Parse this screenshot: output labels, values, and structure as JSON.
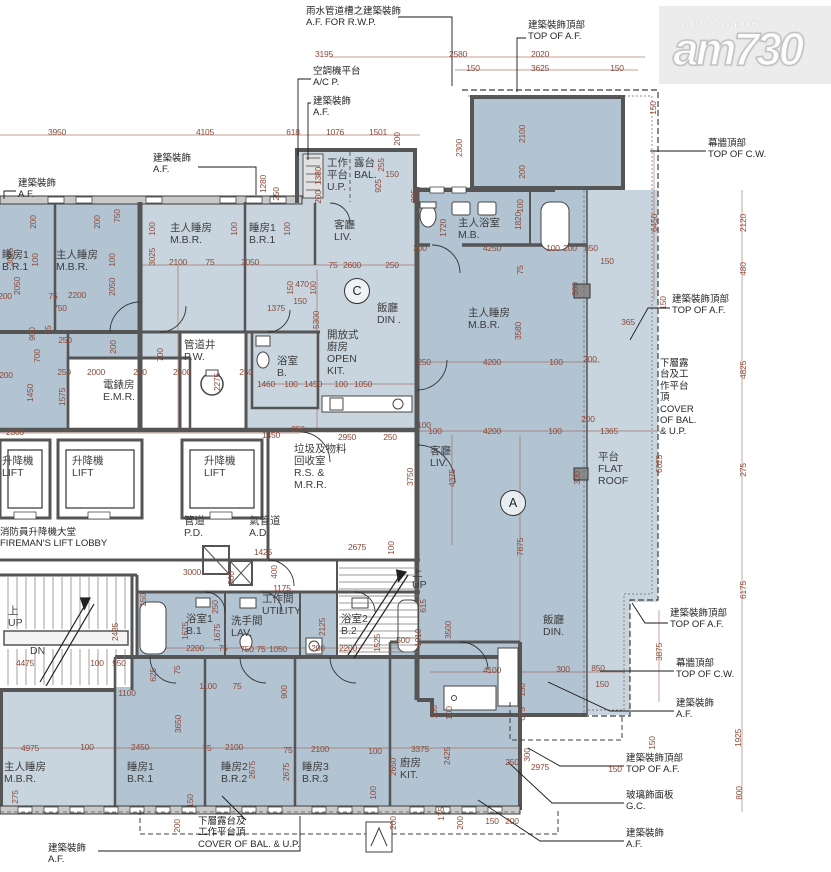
{
  "watermark": {
    "brand": "am730",
    "tagline": "my place my paper"
  },
  "unit_markers": [
    {
      "label": "C",
      "x": 357,
      "y": 291
    },
    {
      "label": "A",
      "x": 513,
      "y": 503
    }
  ],
  "room_labels": [
    {
      "lines": [
        "睡房1",
        "B.R.1"
      ],
      "x": 2,
      "y": 250
    },
    {
      "lines": [
        "主人睡房",
        "M.B.R."
      ],
      "x": 56,
      "y": 250
    },
    {
      "lines": [
        "主人睡房",
        "M.B.R."
      ],
      "x": 170,
      "y": 223
    },
    {
      "lines": [
        "睡房1",
        "B.R.1"
      ],
      "x": 249,
      "y": 223
    },
    {
      "lines": [
        "客廳",
        "LIV."
      ],
      "x": 334,
      "y": 220
    },
    {
      "lines": [
        "工作",
        "平台",
        "U.P."
      ],
      "x": 327,
      "y": 158
    },
    {
      "lines": [
        "露台",
        "BAL."
      ],
      "x": 354,
      "y": 158
    },
    {
      "lines": [
        "飯廳",
        "DIN ."
      ],
      "x": 377,
      "y": 303
    },
    {
      "lines": [
        "開放式",
        "廚房",
        "OPEN",
        "KIT."
      ],
      "x": 327,
      "y": 330
    },
    {
      "lines": [
        "浴室",
        "B."
      ],
      "x": 277,
      "y": 356
    },
    {
      "lines": [
        "管道井",
        "P.W."
      ],
      "x": 184,
      "y": 340
    },
    {
      "lines": [
        "電錶房",
        "E.M.R."
      ],
      "x": 103,
      "y": 380
    },
    {
      "lines": [
        "主人浴室",
        "M.B."
      ],
      "x": 458,
      "y": 218
    },
    {
      "lines": [
        "主人睡房",
        "M.B.R."
      ],
      "x": 468,
      "y": 308
    },
    {
      "lines": [
        "客廳",
        "LIV."
      ],
      "x": 430,
      "y": 446
    },
    {
      "lines": [
        "平台",
        "FLAT",
        "ROOF"
      ],
      "x": 598,
      "y": 452
    },
    {
      "lines": [
        "飯廳",
        "DIN."
      ],
      "x": 543,
      "y": 615
    },
    {
      "lines": [
        "升降機",
        "LIFT"
      ],
      "x": 2,
      "y": 456
    },
    {
      "lines": [
        "升降機",
        "LIFT"
      ],
      "x": 72,
      "y": 456
    },
    {
      "lines": [
        "升降機",
        "LIFT"
      ],
      "x": 204,
      "y": 456
    },
    {
      "lines": [
        "垃圾及物料",
        "回收室",
        "R.S. &",
        "M.R.R."
      ],
      "x": 294,
      "y": 444
    },
    {
      "lines": [
        "管道",
        "P.D."
      ],
      "x": 184,
      "y": 516
    },
    {
      "lines": [
        "氣管道",
        "A.D."
      ],
      "x": 249,
      "y": 516
    },
    {
      "lines": [
        "上",
        "UP"
      ],
      "x": 8,
      "y": 606
    },
    {
      "lines": [
        "DN"
      ],
      "x": 30,
      "y": 646
    },
    {
      "lines": [
        "上",
        "UP"
      ],
      "x": 412,
      "y": 568
    },
    {
      "lines": [
        "工作間",
        "UTILITY"
      ],
      "x": 262,
      "y": 594
    },
    {
      "lines": [
        "浴室1",
        "B.1"
      ],
      "x": 186,
      "y": 614
    },
    {
      "lines": [
        "洗手間",
        "LAV."
      ],
      "x": 231,
      "y": 616
    },
    {
      "lines": [
        "浴室2",
        "B.2"
      ],
      "x": 341,
      "y": 614
    },
    {
      "lines": [
        "主人睡房",
        "M.B.R."
      ],
      "x": 4,
      "y": 762
    },
    {
      "lines": [
        "睡房1",
        "B.R.1"
      ],
      "x": 127,
      "y": 762
    },
    {
      "lines": [
        "睡房2",
        "B.R.2"
      ],
      "x": 221,
      "y": 762
    },
    {
      "lines": [
        "睡房3",
        "B.R.3"
      ],
      "x": 302,
      "y": 762
    },
    {
      "lines": [
        "廚房",
        "KIT."
      ],
      "x": 400,
      "y": 758
    }
  ],
  "callouts": [
    {
      "lines": [
        "雨水管道槽之建築裝飾",
        "A.F. FOR R.W.P."
      ],
      "x": 306,
      "y": 6
    },
    {
      "lines": [
        "空調機平台",
        "A/C P."
      ],
      "x": 313,
      "y": 66
    },
    {
      "lines": [
        "建築裝飾",
        "A.F."
      ],
      "x": 313,
      "y": 96
    },
    {
      "lines": [
        "建築裝飾",
        "A.F."
      ],
      "x": 153,
      "y": 153
    },
    {
      "lines": [
        "建築裝飾",
        "A.F."
      ],
      "x": 18,
      "y": 178
    },
    {
      "lines": [
        "建築裝飾頂部",
        "TOP OF A.F."
      ],
      "x": 528,
      "y": 20
    },
    {
      "lines": [
        "幕牆頂部",
        "TOP OF C.W."
      ],
      "x": 708,
      "y": 138
    },
    {
      "lines": [
        "建築裝飾頂部",
        "TOP OF A.F."
      ],
      "x": 672,
      "y": 294
    },
    {
      "lines": [
        "下層露",
        "台及工",
        "作平台",
        "頂",
        "COVER",
        "OF BAL.",
        "& U.P."
      ],
      "x": 660,
      "y": 358
    },
    {
      "lines": [
        "建築裝飾頂部",
        "TOP OF A.F."
      ],
      "x": 670,
      "y": 608
    },
    {
      "lines": [
        "幕牆頂部",
        "TOP OF C.W."
      ],
      "x": 676,
      "y": 658
    },
    {
      "lines": [
        "建築裝飾",
        "A.F."
      ],
      "x": 676,
      "y": 698
    },
    {
      "lines": [
        "建築裝飾頂部",
        "TOP OF A.F."
      ],
      "x": 626,
      "y": 753
    },
    {
      "lines": [
        "玻璃飾面板",
        "G.C."
      ],
      "x": 626,
      "y": 790
    },
    {
      "lines": [
        "建築裝飾",
        "A.F."
      ],
      "x": 626,
      "y": 828
    },
    {
      "lines": [
        "建築裝飾",
        "A.F."
      ],
      "x": 48,
      "y": 843
    },
    {
      "lines": [
        "下層露台及",
        "工作平台頂",
        "COVER OF BAL. & U.P."
      ],
      "x": 198,
      "y": 816
    },
    {
      "lines": [
        "消防員升降機大堂",
        "FIREMAN'S LIFT LOBBY"
      ],
      "x": 0,
      "y": 527
    }
  ],
  "dims": [
    [
      "3195",
      324,
      54,
      0
    ],
    [
      "2580",
      458,
      54,
      0
    ],
    [
      "2020",
      540,
      54,
      0
    ],
    [
      "150",
      473,
      68,
      0
    ],
    [
      "3625",
      540,
      68,
      0
    ],
    [
      "150",
      617,
      68,
      0
    ],
    [
      "3950",
      57,
      132,
      0
    ],
    [
      "4105",
      205,
      132,
      0
    ],
    [
      "618",
      293,
      132,
      0
    ],
    [
      "1076",
      335,
      132,
      0
    ],
    [
      "1501",
      378,
      132,
      0
    ],
    [
      "200",
      397,
      139,
      1
    ],
    [
      "150",
      653,
      108,
      1
    ],
    [
      "2300",
      459,
      148,
      1
    ],
    [
      "2100",
      522,
      134,
      1
    ],
    [
      "200",
      522,
      172,
      1
    ],
    [
      "1280",
      263,
      184,
      1
    ],
    [
      "250",
      276,
      194,
      1
    ],
    [
      "1380",
      318,
      176,
      1
    ],
    [
      "200",
      318,
      197,
      1
    ],
    [
      "925",
      378,
      186,
      1
    ],
    [
      "255",
      381,
      165,
      1
    ],
    [
      "150",
      392,
      174,
      0
    ],
    [
      "905",
      414,
      196,
      1
    ],
    [
      "6450",
      654,
      223,
      1
    ],
    [
      "2120",
      743,
      223,
      1
    ],
    [
      "480",
      743,
      269,
      1
    ],
    [
      "4825",
      743,
      370,
      1
    ],
    [
      "150",
      663,
      303,
      1
    ],
    [
      "365",
      628,
      322,
      0
    ],
    [
      "200",
      33,
      222,
      1
    ],
    [
      "200",
      97,
      222,
      1
    ],
    [
      "750",
      117,
      216,
      1
    ],
    [
      "100",
      35,
      260,
      1
    ],
    [
      "100",
      112,
      260,
      1
    ],
    [
      "2050",
      17,
      286,
      1
    ],
    [
      "2050",
      112,
      287,
      1
    ],
    [
      "100",
      152,
      229,
      1
    ],
    [
      "100",
      234,
      229,
      1
    ],
    [
      "100",
      287,
      229,
      1
    ],
    [
      "2100",
      178,
      262,
      0
    ],
    [
      "75",
      210,
      262,
      0
    ],
    [
      "2050",
      250,
      262,
      0
    ],
    [
      "75",
      333,
      265,
      0
    ],
    [
      "2600",
      352,
      265,
      0
    ],
    [
      "250",
      392,
      265,
      0
    ],
    [
      "3025",
      10,
      257,
      1
    ],
    [
      "3025",
      152,
      257,
      1
    ],
    [
      "2200",
      77,
      295,
      0
    ],
    [
      "75",
      53,
      296,
      0
    ],
    [
      "200",
      5,
      296,
      0
    ],
    [
      "750",
      60,
      308,
      0
    ],
    [
      "1375",
      276,
      308,
      0
    ],
    [
      "5300",
      316,
      320,
      1
    ],
    [
      "150",
      290,
      288,
      1
    ],
    [
      "470",
      302,
      284,
      0
    ],
    [
      "100",
      313,
      288,
      1
    ],
    [
      "150",
      300,
      301,
      0
    ],
    [
      "900",
      32,
      334,
      1
    ],
    [
      "75",
      48,
      330,
      1
    ],
    [
      "250",
      65,
      340,
      0
    ],
    [
      "700",
      37,
      356,
      1
    ],
    [
      "700",
      160,
      355,
      1
    ],
    [
      "200",
      113,
      347,
      1
    ],
    [
      "200",
      6,
      375,
      0
    ],
    [
      "1450",
      30,
      393,
      1
    ],
    [
      "1575",
      62,
      397,
      1
    ],
    [
      "250",
      64,
      372,
      0
    ],
    [
      "2000",
      96,
      372,
      0
    ],
    [
      "250",
      140,
      372,
      0
    ],
    [
      "2500",
      182,
      372,
      0
    ],
    [
      "2275",
      217,
      382,
      1
    ],
    [
      "250",
      246,
      372,
      0
    ],
    [
      "1460",
      266,
      384,
      0
    ],
    [
      "100",
      291,
      384,
      0
    ],
    [
      "1450",
      313,
      384,
      0
    ],
    [
      "100",
      341,
      384,
      0
    ],
    [
      "1050",
      363,
      384,
      0
    ],
    [
      "200",
      420,
      248,
      0
    ],
    [
      "4250",
      492,
      248,
      0
    ],
    [
      "100",
      553,
      248,
      0
    ],
    [
      "200",
      570,
      248,
      0
    ],
    [
      "850",
      591,
      248,
      0
    ],
    [
      "150",
      607,
      261,
      0
    ],
    [
      "1720",
      443,
      228,
      1
    ],
    [
      "1820",
      518,
      221,
      1
    ],
    [
      "100",
      520,
      206,
      1
    ],
    [
      "75",
      520,
      270,
      1
    ],
    [
      "300",
      575,
      289,
      1
    ],
    [
      "3580",
      518,
      331,
      1
    ],
    [
      "250",
      424,
      362,
      0
    ],
    [
      "4200",
      492,
      362,
      0
    ],
    [
      "100",
      556,
      362,
      0
    ],
    [
      "200",
      590,
      359,
      0
    ],
    [
      "100",
      435,
      431,
      0
    ],
    [
      "4200",
      492,
      431,
      0
    ],
    [
      "100",
      555,
      431,
      0
    ],
    [
      "200",
      588,
      419,
      0
    ],
    [
      "1365",
      609,
      431,
      0
    ],
    [
      "2300",
      15,
      432,
      0
    ],
    [
      "1450",
      271,
      435,
      0
    ],
    [
      "250",
      298,
      429,
      0
    ],
    [
      "2950",
      347,
      437,
      0
    ],
    [
      "250",
      390,
      437,
      0
    ],
    [
      "100",
      424,
      425,
      0
    ],
    [
      "3750",
      410,
      477,
      1
    ],
    [
      "4375",
      452,
      478,
      1
    ],
    [
      "7875",
      520,
      547,
      1
    ],
    [
      "300",
      577,
      478,
      1
    ],
    [
      "6025",
      659,
      464,
      1
    ],
    [
      "275",
      743,
      470,
      1
    ],
    [
      "6175",
      743,
      590,
      1
    ],
    [
      "3000",
      192,
      572,
      0
    ],
    [
      "1425",
      263,
      552,
      0
    ],
    [
      "2675",
      357,
      547,
      0
    ],
    [
      "100",
      391,
      548,
      1
    ],
    [
      "400",
      274,
      572,
      1
    ],
    [
      "300",
      231,
      578,
      1
    ],
    [
      "1175",
      282,
      588,
      0
    ],
    [
      "150",
      143,
      600,
      1
    ],
    [
      "250",
      215,
      607,
      1
    ],
    [
      "2125",
      322,
      627,
      1
    ],
    [
      "1675",
      185,
      631,
      1
    ],
    [
      "1675",
      217,
      633,
      1
    ],
    [
      "1525",
      377,
      643,
      1
    ],
    [
      "2200",
      195,
      648,
      0
    ],
    [
      "75",
      223,
      648,
      0
    ],
    [
      "750",
      247,
      649,
      0
    ],
    [
      "75",
      261,
      649,
      0
    ],
    [
      "1050",
      278,
      649,
      0
    ],
    [
      "200",
      318,
      648,
      0
    ],
    [
      "2200",
      348,
      648,
      0
    ],
    [
      "625",
      153,
      675,
      1
    ],
    [
      "75",
      177,
      670,
      1
    ],
    [
      "1100",
      208,
      686,
      0
    ],
    [
      "75",
      237,
      686,
      0
    ],
    [
      "900",
      284,
      692,
      1
    ],
    [
      "2425",
      115,
      632,
      1
    ],
    [
      "100",
      97,
      663,
      0
    ],
    [
      "950",
      119,
      663,
      0
    ],
    [
      "4475",
      25,
      663,
      0
    ],
    [
      "1100",
      127,
      693,
      0
    ],
    [
      "3500",
      448,
      630,
      1
    ],
    [
      "1010",
      418,
      638,
      1
    ],
    [
      "615",
      423,
      606,
      1
    ],
    [
      "500",
      403,
      640,
      0
    ],
    [
      "150",
      522,
      690,
      1
    ],
    [
      "675",
      522,
      714,
      1
    ],
    [
      "100",
      434,
      712,
      1
    ],
    [
      "4100",
      492,
      670,
      0
    ],
    [
      "300",
      563,
      669,
      0
    ],
    [
      "850",
      598,
      668,
      0
    ],
    [
      "150",
      602,
      684,
      0
    ],
    [
      "3650",
      178,
      724,
      1
    ],
    [
      "4975",
      30,
      748,
      0
    ],
    [
      "100",
      87,
      747,
      0
    ],
    [
      "2450",
      140,
      747,
      0
    ],
    [
      "75",
      207,
      748,
      0
    ],
    [
      "2100",
      234,
      747,
      0
    ],
    [
      "75",
      288,
      750,
      0
    ],
    [
      "2100",
      320,
      749,
      0
    ],
    [
      "100",
      375,
      751,
      0
    ],
    [
      "3375",
      420,
      749,
      0
    ],
    [
      "2675",
      252,
      770,
      1
    ],
    [
      "2675",
      286,
      772,
      1
    ],
    [
      "2650",
      393,
      767,
      1
    ],
    [
      "2425",
      447,
      756,
      1
    ],
    [
      "275",
      15,
      797,
      1
    ],
    [
      "150",
      190,
      801,
      1
    ],
    [
      "200",
      177,
      826,
      1
    ],
    [
      "100",
      373,
      793,
      1
    ],
    [
      "200",
      393,
      823,
      1
    ],
    [
      "175",
      441,
      814,
      1
    ],
    [
      "200",
      460,
      823,
      1
    ],
    [
      "150",
      492,
      821,
      0
    ],
    [
      "200",
      512,
      821,
      0
    ],
    [
      "100",
      449,
      713,
      1
    ],
    [
      "250",
      512,
      762,
      0
    ],
    [
      "300",
      527,
      755,
      1
    ],
    [
      "2975",
      540,
      767,
      0
    ],
    [
      "150",
      615,
      769,
      0
    ],
    [
      "150",
      652,
      743,
      1
    ],
    [
      "3875",
      659,
      652,
      1
    ],
    [
      "1925",
      738,
      738,
      1
    ],
    [
      "800",
      739,
      793,
      1
    ]
  ]
}
